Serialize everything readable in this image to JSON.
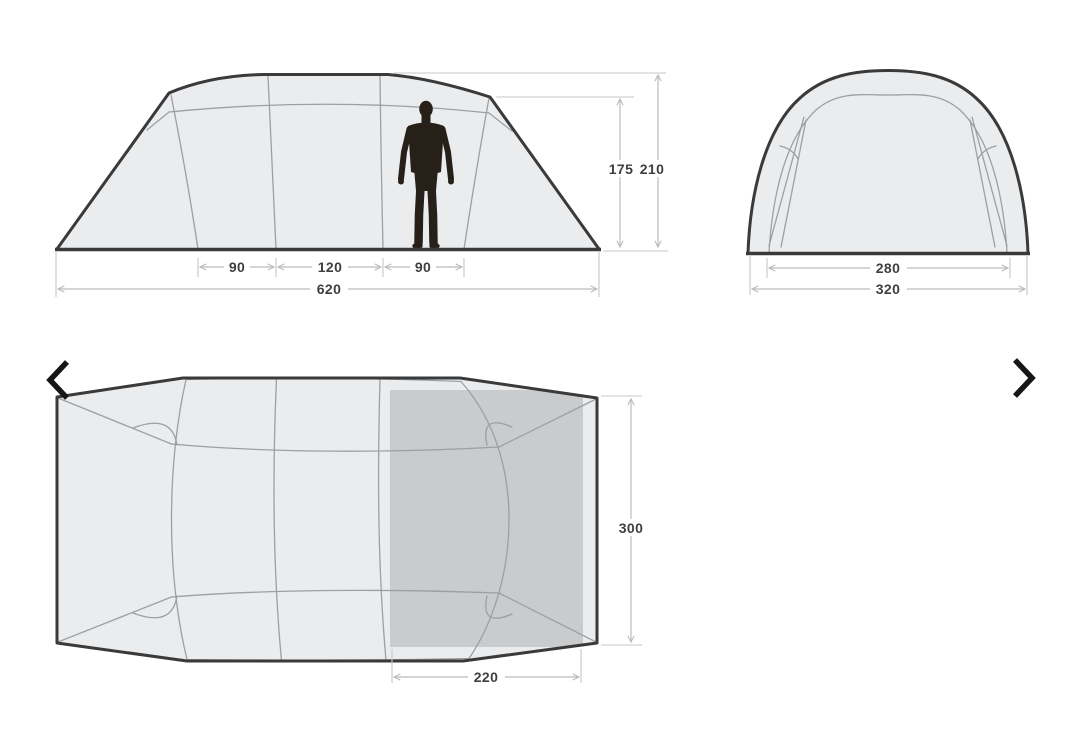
{
  "carousel": {
    "prev_icon": "chevron-left-icon",
    "next_icon": "chevron-right-icon"
  },
  "diagram": {
    "side_view": {
      "sections": [
        "90",
        "120",
        "90"
      ],
      "total_width": "620",
      "inner_height": "175",
      "peak_height": "210"
    },
    "end_view": {
      "inner_width": "280",
      "outer_width": "320"
    },
    "floor_plan": {
      "depth": "300",
      "cabin_width": "220"
    }
  },
  "colors": {
    "outline": "#3a3a3a",
    "panel_fill": "#ebecee",
    "cabin_fill": "#c9cbcd",
    "seam_line": "#9aa0a4",
    "dimension_line": "#b9bcbe",
    "dimension_text": "#3f3f41",
    "silhouette": "#262019",
    "nav_arrow": "#161616"
  }
}
